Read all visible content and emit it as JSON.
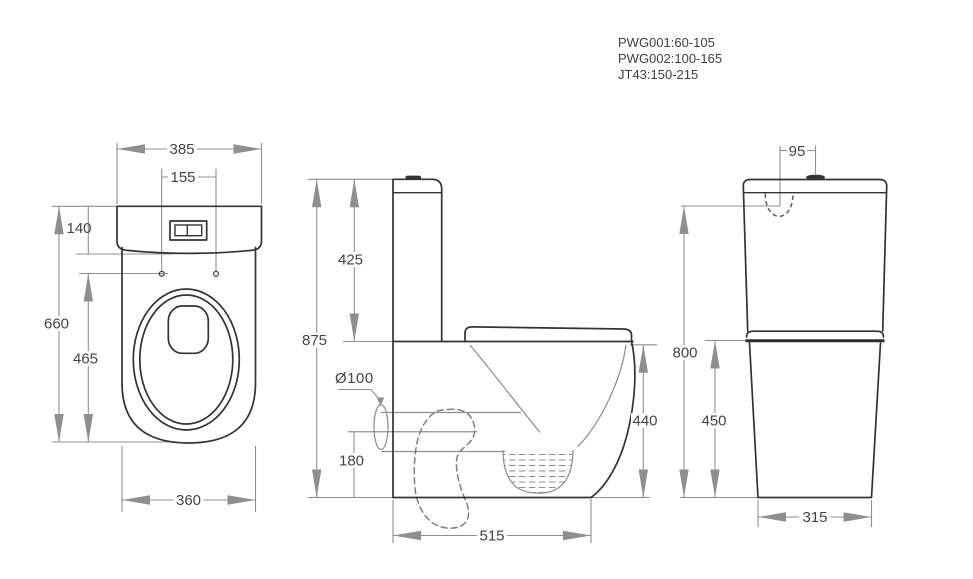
{
  "canvas": {
    "width": 973,
    "height": 579,
    "background": "#ffffff"
  },
  "colors": {
    "object_line": "#333333",
    "dimension_line": "#8f8f8f",
    "label_text": "#444444",
    "annotation_text": "#3f3f3f"
  },
  "annotations": {
    "product_codes": [
      "PWG001:60-105",
      "PWG002:100-165",
      "JT43:150-215"
    ]
  },
  "views": {
    "front": {
      "dimensions": {
        "overall_width": "385",
        "seat_hole_spacing": "155",
        "lid_height": "140",
        "overall_height": "660",
        "seat_height": "465",
        "base_width": "360"
      }
    },
    "side": {
      "dimensions": {
        "cistern_height": "425",
        "overall_height": "875",
        "outlet_diameter": "Ø100",
        "outlet_height": "180",
        "rim_height": "440",
        "overall_depth": "515"
      }
    },
    "rear": {
      "dimensions": {
        "inlet_offset": "95",
        "inlet_height": "800",
        "pan_height": "450",
        "base_width": "315"
      }
    }
  }
}
